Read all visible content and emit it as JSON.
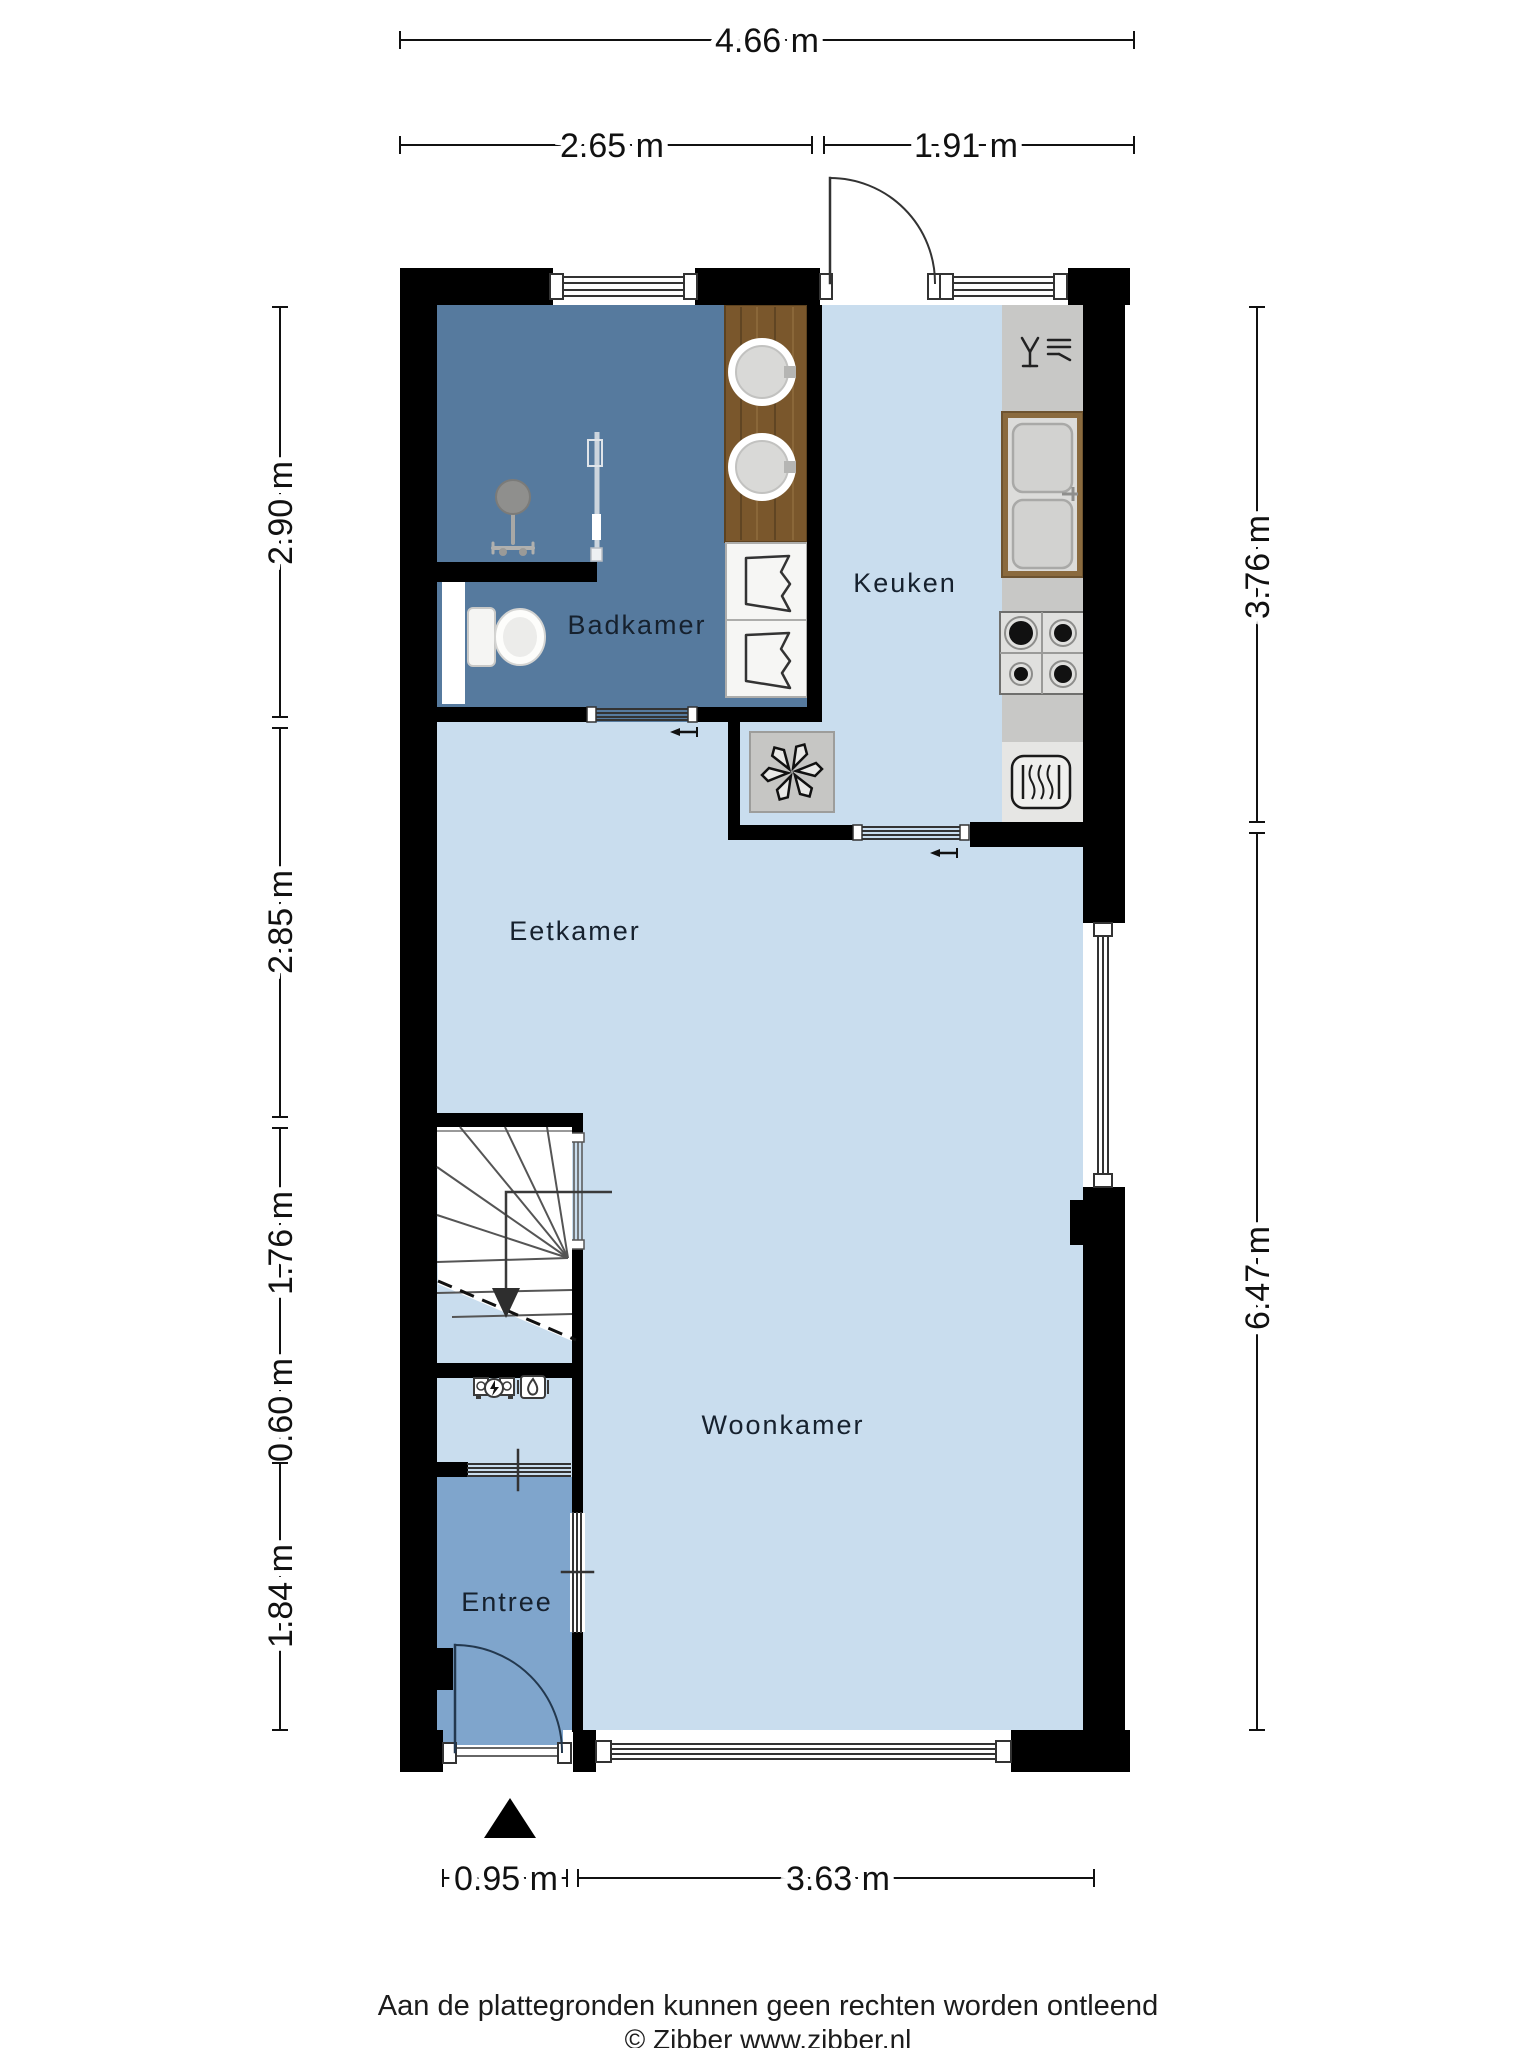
{
  "plan": {
    "title": "floor-plan",
    "rooms": [
      {
        "id": "badkamer",
        "label": "Badkamer"
      },
      {
        "id": "keuken",
        "label": "Keuken"
      },
      {
        "id": "eetkamer",
        "label": "Eetkamer"
      },
      {
        "id": "woonkamer",
        "label": "Woonkamer"
      },
      {
        "id": "entree",
        "label": "Entree"
      }
    ],
    "dimensions": {
      "top": [
        {
          "label": "4.66 m"
        },
        {
          "label": "2.65 m"
        },
        {
          "label": "1.91 m"
        }
      ],
      "left": [
        {
          "label": "2.90 m"
        },
        {
          "label": "2.85 m"
        },
        {
          "label": "1.76 m"
        },
        {
          "label": "0.60 m"
        },
        {
          "label": "1.84 m"
        }
      ],
      "right": [
        {
          "label": "3.76 m"
        },
        {
          "label": "6.47 m"
        }
      ],
      "bottom": [
        {
          "label": "0.95 m"
        },
        {
          "label": "3.63 m"
        }
      ]
    },
    "colors": {
      "wall": "#000000",
      "floor_light": "#c9ddee",
      "floor_bathroom": "#567a9e",
      "floor_entree": "#7fa5cc",
      "counter_gray": "#c8c8c6",
      "counter_light": "#e6e6e4",
      "wood": "#7a572c",
      "line": "#333333"
    },
    "icons": [
      "shower-icon",
      "toilet-icon",
      "sink-icon",
      "wardrobe-icon",
      "dishwasher-icon",
      "kitchen-sink-icon",
      "stove-icon",
      "oven-icon",
      "ventilation-fan-icon",
      "electric-meter-icon",
      "gas-meter-icon",
      "stairs-down-arrow-icon",
      "entrance-triangle-icon"
    ]
  },
  "footer": {
    "disclaimer": "Aan de plattegronden kunnen geen rechten worden ontleend",
    "credit": "© Zibber www.zibber.nl"
  }
}
